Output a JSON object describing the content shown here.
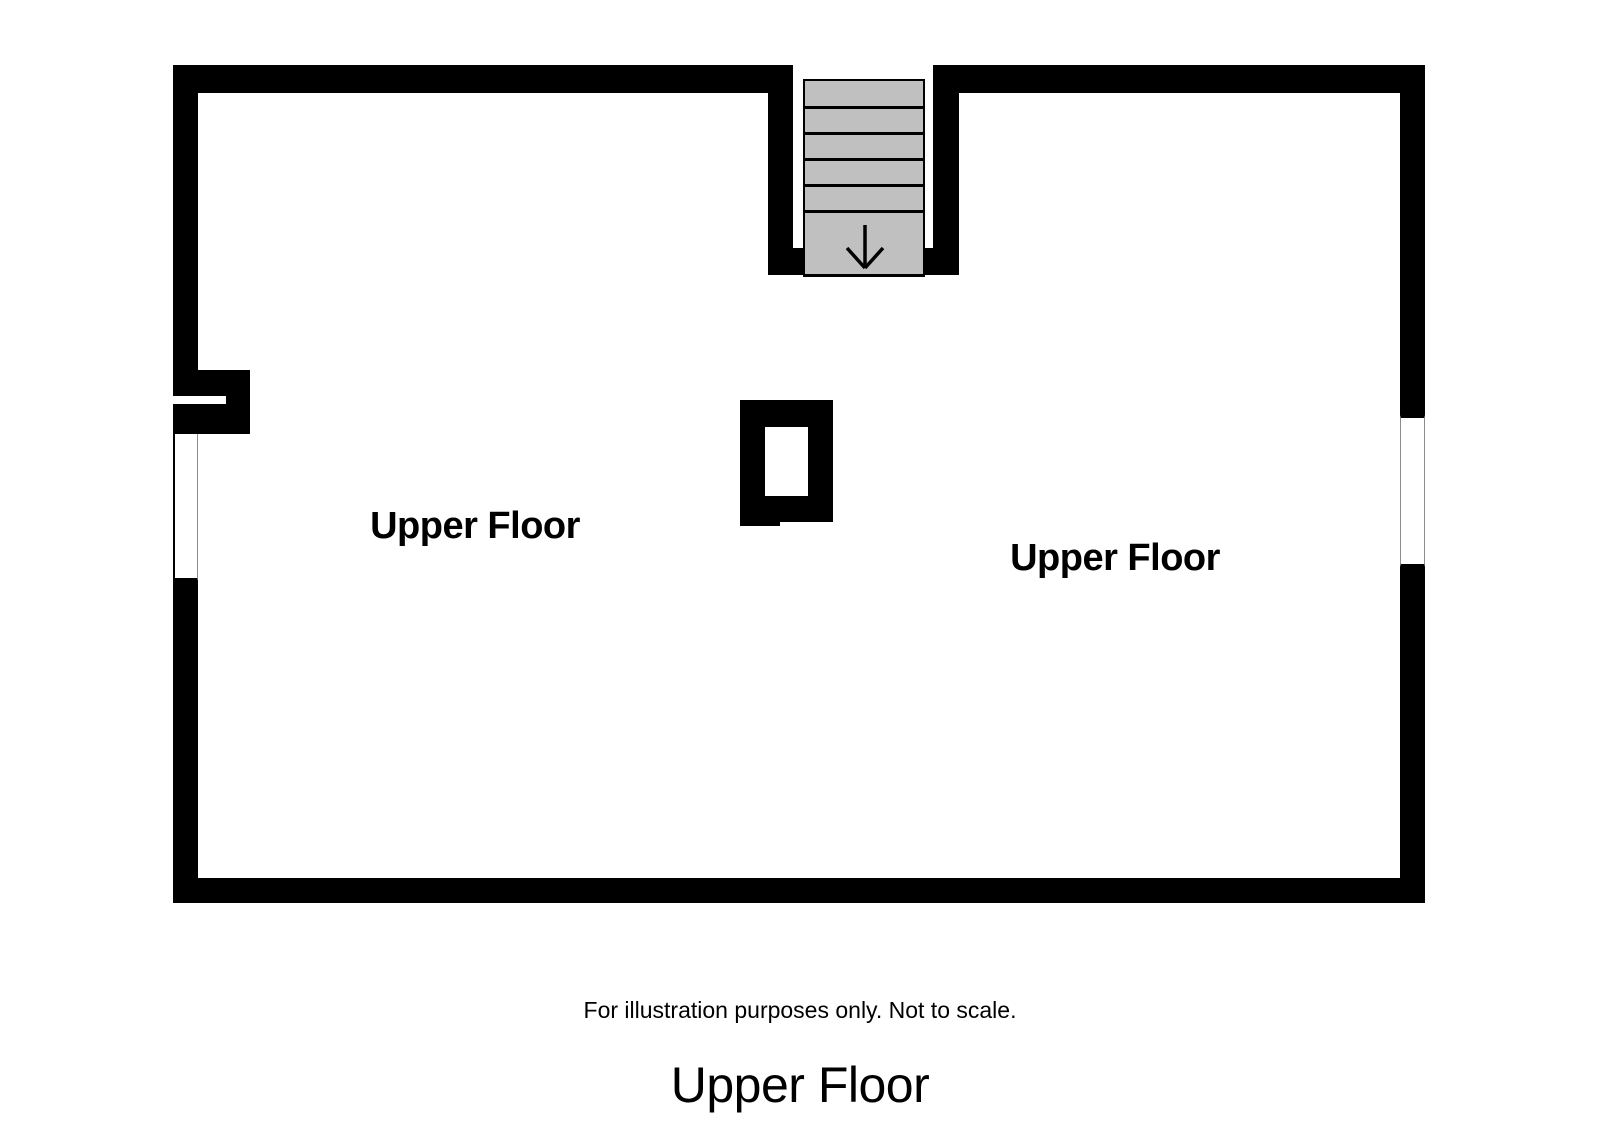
{
  "page": {
    "caption": "For illustration purposes only. Not to scale.",
    "title": "Upper Floor"
  },
  "plan": {
    "rooms": [
      {
        "label": "Upper Floor"
      },
      {
        "label": "Upper Floor"
      }
    ],
    "stairs": {
      "direction": "down",
      "tread_count": 5,
      "arrow_icon": "arrow-down"
    },
    "features": {
      "windows": 2,
      "chimney": 1,
      "door_openings": 1
    },
    "colors": {
      "wall": "#000000",
      "stair_fill": "#c0c0c0",
      "background": "#ffffff"
    }
  }
}
